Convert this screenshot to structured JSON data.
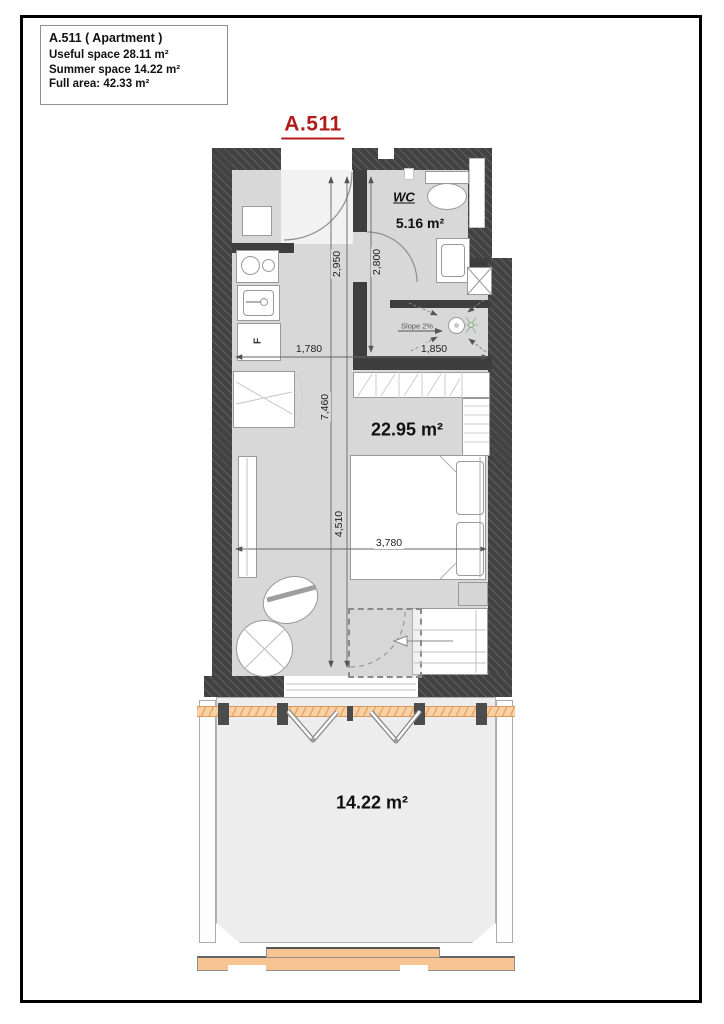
{
  "info_box": {
    "title": "A.511 ( Apartment )",
    "useful_space": "Useful space 28.11 m²",
    "summer_space": "Summer space 14.22 m²",
    "full_area": "Full area: 42.33 m²"
  },
  "plan": {
    "unit_title": "A.511",
    "wc": {
      "name": "WC",
      "area": "5.16 m²"
    },
    "main_room": {
      "area": "22.95 m²"
    },
    "terrace": {
      "area": "14.22 m²"
    },
    "dimensions": {
      "hall_length": "2,950",
      "wc_length": "2,800",
      "hall_width": "1,780",
      "wc_width": "1,850",
      "interior_length": "7,460",
      "room_length": "4,510",
      "room_width": "3,780"
    },
    "annotations": {
      "slope": "Slope 2%",
      "fridge": "F"
    }
  },
  "colors": {
    "wall_dark": "#424242",
    "floor_gray": "#d8d8d8",
    "accent_red": "#b11d1d",
    "terrace_trim_orange": "#f2b77f"
  }
}
